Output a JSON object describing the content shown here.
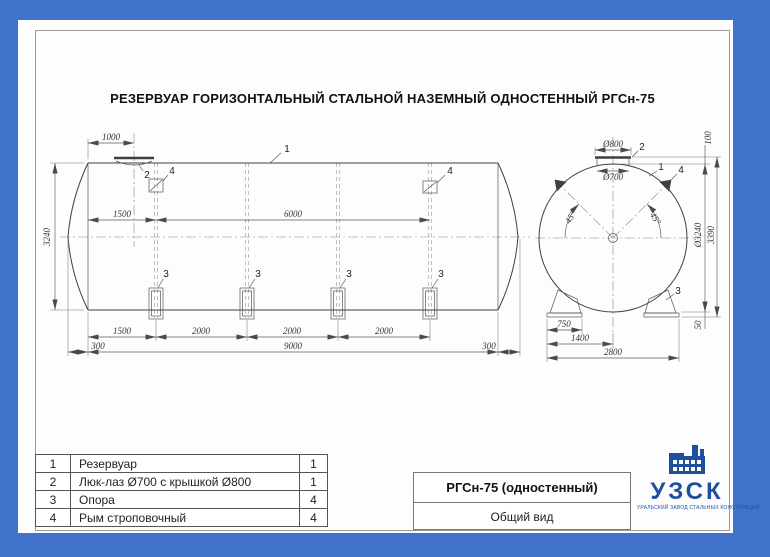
{
  "title": "РЕЗЕРВУАР ГОРИЗОНТАЛЬНЫЙ СТАЛЬНОЙ НАЗЕМНЫЙ ОДНОСТЕННЫЙ РГСн-75",
  "side_view": {
    "callouts": {
      "tank": "1",
      "hatch": "2",
      "support": "3",
      "lug": "4"
    },
    "dims": {
      "hatch_offset": "1000",
      "lug_offset": "1500",
      "lug_span": "6000",
      "shell_diameter": "3240",
      "chain": [
        "1500",
        "2000",
        "2000",
        "2000"
      ],
      "head_left": "300",
      "cylinder_length": "9000",
      "head_right": "300"
    }
  },
  "end_view": {
    "callouts": {
      "tank": "1",
      "hatch": "2",
      "support": "3",
      "lug": "4"
    },
    "dims": {
      "cover_diameter": "Ø800",
      "manhole_diameter": "Ø700",
      "hatch_height": "100",
      "shell_diameter": "Ø3240",
      "overall_height": "3390",
      "base_height": "50",
      "angle_left": "45°",
      "angle_right": "45°",
      "base_plate": "750",
      "support_center": "1400",
      "support_span": "2800"
    }
  },
  "parts_table": {
    "rows": [
      {
        "num": "1",
        "name": "Резервуар",
        "qty": "1"
      },
      {
        "num": "2",
        "name": "Люк-лаз Ø700 с крышкой Ø800",
        "qty": "1"
      },
      {
        "num": "3",
        "name": "Опора",
        "qty": "4"
      },
      {
        "num": "4",
        "name": "Рым строповочный",
        "qty": "4"
      }
    ]
  },
  "title_block": {
    "model": "РГСн-75 (одностенный)",
    "view_name": "Общий вид"
  },
  "logo": {
    "abbr": "УЗСК",
    "tagline": "УРАЛЬСКИЙ ЗАВОД СТАЛЬНЫХ КОНСТРУКЦИЙ"
  },
  "colors": {
    "border_blue": "#3F72C8",
    "logo_blue": "#1E4F9F"
  }
}
